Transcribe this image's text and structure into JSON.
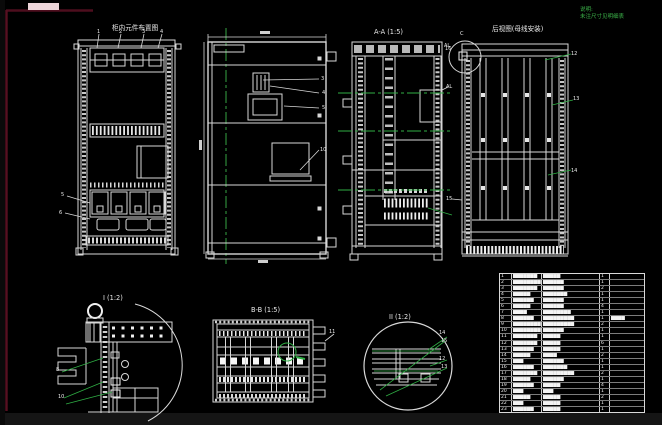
{
  "canvas": {
    "width": 662,
    "height": 425,
    "bg": "#000000",
    "sheet_frame_color": "#571021",
    "highlight_bar_color": "#ecd4d8",
    "line_color": "#d8d8d8",
    "accent_green": "#3cb54a"
  },
  "note": {
    "line1": "说明:",
    "line2": "未注尺寸见明细表"
  },
  "views": {
    "front_components": {
      "title": "柜内元件布置图"
    },
    "section_aa": {
      "title": "A-A (1:5)"
    },
    "rear_busbar": {
      "title": "后视图(母线安装)"
    },
    "detail_i": {
      "title": "I (1:2)"
    },
    "plan_bb": {
      "title": "B-B (1:5)"
    },
    "detail_ii": {
      "title": "II (1:2)"
    }
  },
  "labels": [
    {
      "t": "1",
      "x": 97,
      "y": 29
    },
    {
      "t": "2",
      "x": 119,
      "y": 29
    },
    {
      "t": "3",
      "x": 142,
      "y": 29
    },
    {
      "t": "4",
      "x": 160,
      "y": 29
    },
    {
      "t": "5",
      "x": 61,
      "y": 192
    },
    {
      "t": "6",
      "x": 59,
      "y": 210
    },
    {
      "t": "3",
      "x": 321,
      "y": 76
    },
    {
      "t": "4",
      "x": 322,
      "y": 90
    },
    {
      "t": "5",
      "x": 322,
      "y": 105
    },
    {
      "t": "10",
      "x": 320,
      "y": 147
    },
    {
      "t": "AL",
      "x": 444,
      "y": 43
    },
    {
      "t": "AL",
      "x": 446,
      "y": 84
    },
    {
      "t": "C",
      "x": 460,
      "y": 31
    },
    {
      "t": "16",
      "x": 445,
      "y": 46
    },
    {
      "t": "12",
      "x": 571,
      "y": 51
    },
    {
      "t": "13",
      "x": 573,
      "y": 96
    },
    {
      "t": "14",
      "x": 571,
      "y": 168
    },
    {
      "t": "15",
      "x": 446,
      "y": 196
    },
    {
      "t": "8",
      "x": 56,
      "y": 367
    },
    {
      "t": "10",
      "x": 58,
      "y": 394
    },
    {
      "t": "11",
      "x": 329,
      "y": 329
    },
    {
      "t": "14",
      "x": 439,
      "y": 330
    },
    {
      "t": "15",
      "x": 441,
      "y": 338
    },
    {
      "t": "12",
      "x": 439,
      "y": 356
    },
    {
      "t": "13",
      "x": 441,
      "y": 364
    }
  ],
  "table": {
    "rows": [
      {
        "no": "1",
        "name": "▆▆▆▆▆▆▆",
        "spec": "▆▆▆▆▆",
        "qty": "1",
        "remark": ""
      },
      {
        "no": "2",
        "name": "▆▆▆▆▆▆▆▆",
        "spec": "▆▆▆▆▆▆",
        "qty": "1",
        "remark": ""
      },
      {
        "no": "3",
        "name": "▆▆▆▆▆▆▆",
        "spec": "▆▆▆▆▆▆",
        "qty": "2",
        "remark": ""
      },
      {
        "no": "4",
        "name": "▆▆▆▆▆",
        "spec": "▆▆▆▆▆▆▆",
        "qty": "1",
        "remark": ""
      },
      {
        "no": "5",
        "name": "▆▆▆▆▆▆",
        "spec": "▆▆▆▆▆▆",
        "qty": "1",
        "remark": ""
      },
      {
        "no": "6",
        "name": "▆▆▆▆▆",
        "spec": "▆▆▆▆▆▆",
        "qty": "4",
        "remark": ""
      },
      {
        "no": "7",
        "name": "▆▆▆▆",
        "spec": "▆▆▆▆▆▆▆▆",
        "qty": "1",
        "remark": ""
      },
      {
        "no": "8",
        "name": "▆▆▆▆▆▆",
        "spec": "▆▆▆▆▆▆▆▆▆",
        "qty": "1",
        "remark": "▆▆▆▆"
      },
      {
        "no": "9",
        "name": "▆▆▆▆▆▆▆▆",
        "spec": "▆▆▆▆▆▆▆▆▆",
        "qty": "2",
        "remark": ""
      },
      {
        "no": "10",
        "name": "▆▆▆▆▆▆▆▆",
        "spec": "▆▆▆▆▆▆",
        "qty": "1",
        "remark": ""
      },
      {
        "no": "11",
        "name": "▆▆▆▆▆▆▆",
        "spec": "▆▆▆▆▆",
        "qty": "1",
        "remark": ""
      },
      {
        "no": "12",
        "name": "▆▆▆▆▆▆▆",
        "spec": "▆▆▆▆▆",
        "qty": "6",
        "remark": ""
      },
      {
        "no": "13",
        "name": "▆▆▆▆▆▆",
        "spec": "▆▆▆▆▆",
        "qty": "1",
        "remark": ""
      },
      {
        "no": "14",
        "name": "▆▆▆▆▆",
        "spec": "▆▆▆▆",
        "qty": "2",
        "remark": ""
      },
      {
        "no": "15",
        "name": "▆▆▆",
        "spec": "▆▆▆▆▆▆",
        "qty": "1",
        "remark": ""
      },
      {
        "no": "16",
        "name": "▆▆▆▆▆▆",
        "spec": "▆▆▆▆▆▆▆",
        "qty": "1",
        "remark": ""
      },
      {
        "no": "17",
        "name": "▆▆▆▆▆▆▆",
        "spec": "▆▆▆▆▆▆▆▆▆",
        "qty": "2",
        "remark": ""
      },
      {
        "no": "18",
        "name": "▆▆▆▆▆",
        "spec": "▆▆▆▆▆▆",
        "qty": "1",
        "remark": ""
      },
      {
        "no": "19",
        "name": "▆▆▆▆▆▆",
        "spec": "▆▆▆▆▆",
        "qty": "4",
        "remark": ""
      },
      {
        "no": "20",
        "name": "▆▆▆",
        "spec": "▆▆▆",
        "qty": "1",
        "remark": ""
      },
      {
        "no": "21",
        "name": "▆▆▆▆▆",
        "spec": "▆▆▆▆▆",
        "qty": "2",
        "remark": ""
      },
      {
        "no": "22",
        "name": "▆▆▆",
        "spec": "▆▆▆▆▆",
        "qty": "1",
        "remark": ""
      },
      {
        "no": "23",
        "name": "▆▆▆▆▆▆",
        "spec": "▆▆▆▆▆",
        "qty": "1",
        "remark": ""
      }
    ]
  }
}
